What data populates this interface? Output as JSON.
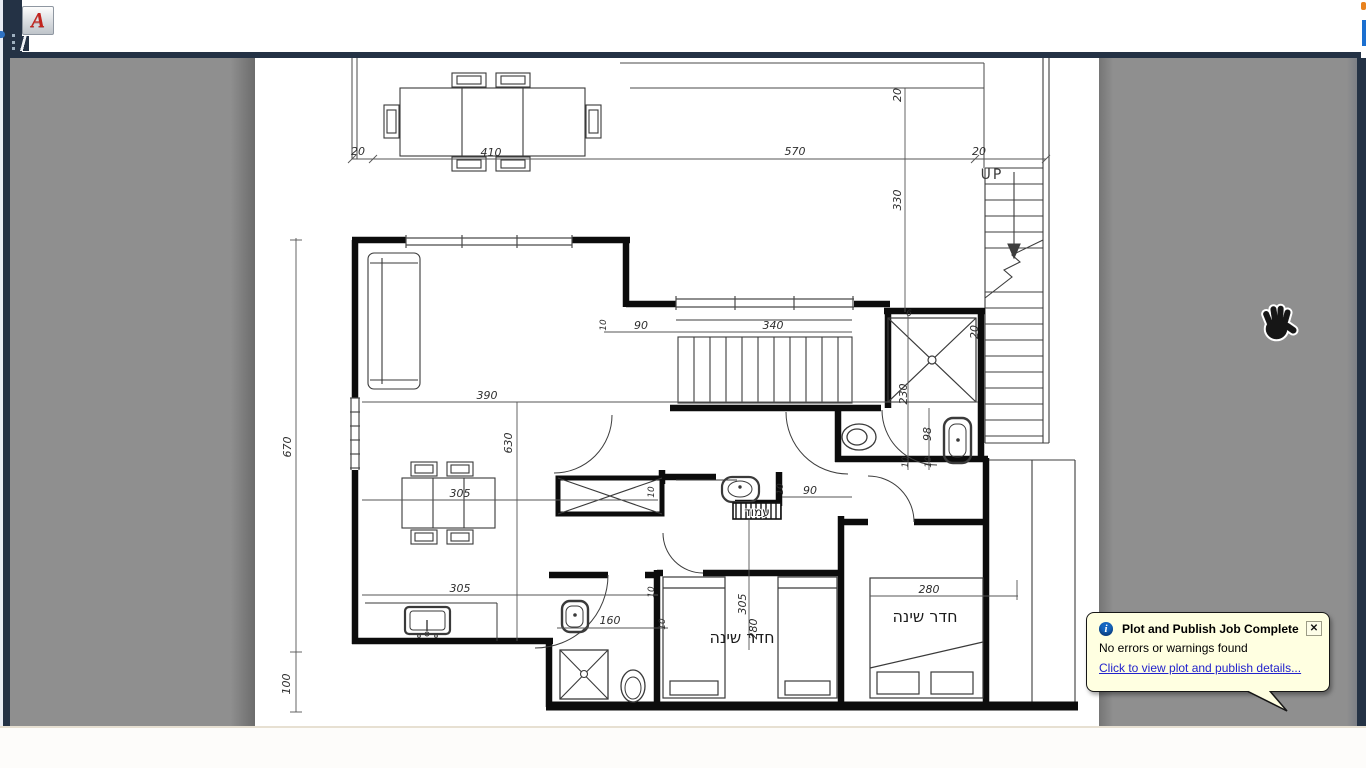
{
  "titlebar": {
    "app_icon_letter": "A"
  },
  "notification": {
    "title": "Plot and Publish Job Complete",
    "message": "No errors or warnings found",
    "link": "Click to view plot and publish details...",
    "close": "✕"
  },
  "colors": {
    "frame_navy": "#243245",
    "canvas_gray": "#8f8f8f",
    "paper_white": "#ffffff",
    "balloon_bg": "#ffffe1",
    "link_blue": "#2222cc",
    "logo_red": "#c2241e",
    "accent_blue": "#1b6fd0",
    "accent_orange": "#e8821e"
  },
  "plan": {
    "labels": {
      "bedroom_left": "חדר שינה",
      "bedroom_right": "חדר שינה",
      "column": "עמוד",
      "stairs_up": "UP"
    },
    "dims": {
      "terrace_20_left": "20",
      "terrace_410": "410",
      "terrace_570": "570",
      "terrace_20_right": "20",
      "roof_20": "20",
      "roof_330": "330",
      "stair_90": "90",
      "stair_340": "340",
      "stair_10": "10",
      "shower_6": "6",
      "shower_20": "20",
      "living_390": "390",
      "living_630": "630",
      "living_670": "670",
      "bath_230": "230",
      "bath_98": "98",
      "bath_10a": "10",
      "bath_10b": "10",
      "vanity_10": "10",
      "vanity_90": "90",
      "kitchen_305a": "305",
      "kitchen_305b": "305",
      "kitchen_10a": "10",
      "kitchen_10b": "10",
      "bath2_160": "160",
      "bath2_10": "10",
      "bed1_305": "305",
      "bed1_280": "280",
      "bed2_280": "280",
      "left_100": "100"
    }
  }
}
